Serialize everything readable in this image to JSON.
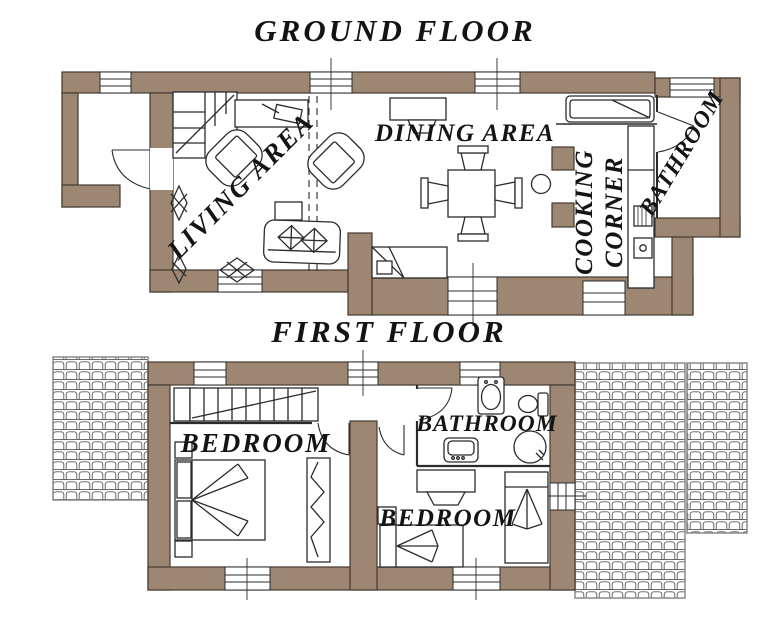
{
  "colors": {
    "wall": "#9d8773",
    "outline": "#41382e",
    "line": "#2b2b2b",
    "tile_line": "#5a5a5a",
    "tile_frame": "#8a8a8a",
    "text": "#141414",
    "paper": "#ffffff"
  },
  "titles": {
    "ground_floor": "GROUND FLOOR",
    "first_floor": "FIRST FLOOR"
  },
  "ground_floor": {
    "rooms": [
      {
        "name": "living-area",
        "label": "LIVING AREA"
      },
      {
        "name": "dining-area",
        "label": "DINING AREA"
      },
      {
        "name": "cooking-corner",
        "label": "COOKING CORNER",
        "lines": [
          "COOKING",
          "CORNER"
        ]
      },
      {
        "name": "bathroom",
        "label": "BATHROOM"
      }
    ]
  },
  "first_floor": {
    "rooms": [
      {
        "name": "bedroom-main",
        "label": "BEDROOM"
      },
      {
        "name": "bathroom",
        "label": "BATHROOM"
      },
      {
        "name": "bedroom-second",
        "label": "BEDROOM"
      }
    ]
  }
}
